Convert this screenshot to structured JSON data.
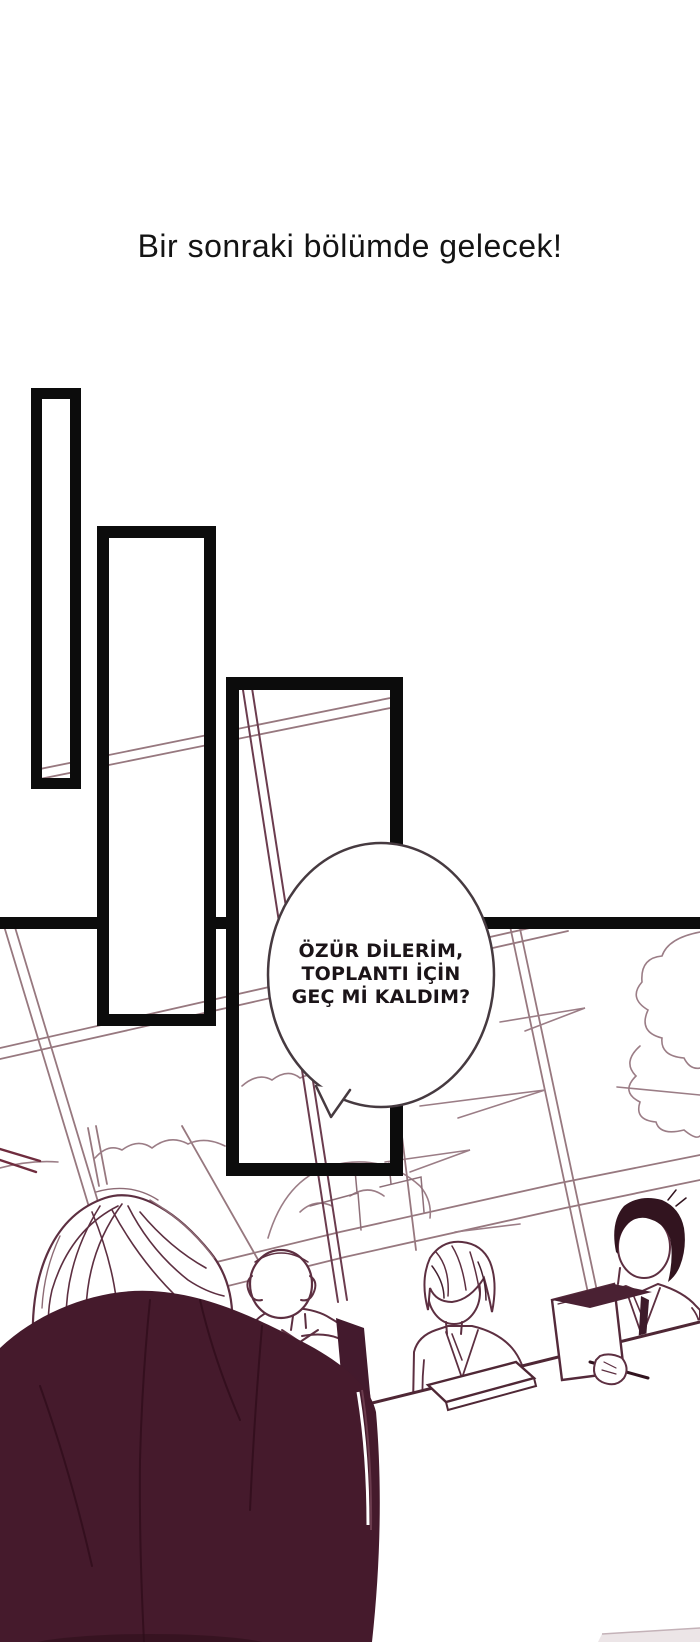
{
  "header": {
    "title": "Bir sonraki bölümde gelecek!"
  },
  "speech_bubble": {
    "speaker": "off-panel character arriving at meeting",
    "lines": [
      "ÖZÜR DİLERİM,",
      "TOPLANTI İÇİN",
      "GEÇ Mİ KALDIM?"
    ]
  },
  "panels": {
    "staircase_frame_count": 3,
    "scene": "sketched meeting room with window, clouds, three seated colleagues and a dark-jacketed foreground figure"
  },
  "colors": {
    "ink_black": "#0c0c0c",
    "paper_white": "#ffffff",
    "sketch_light": "#97787f",
    "sketch_dark": "#5d2f41",
    "jacket_fill": "#451a2c",
    "hair_fill": "#32141f",
    "chair_fill": "#431a2d",
    "bubble_outline": "#463a40",
    "roof_red": "#6f2c3e"
  }
}
